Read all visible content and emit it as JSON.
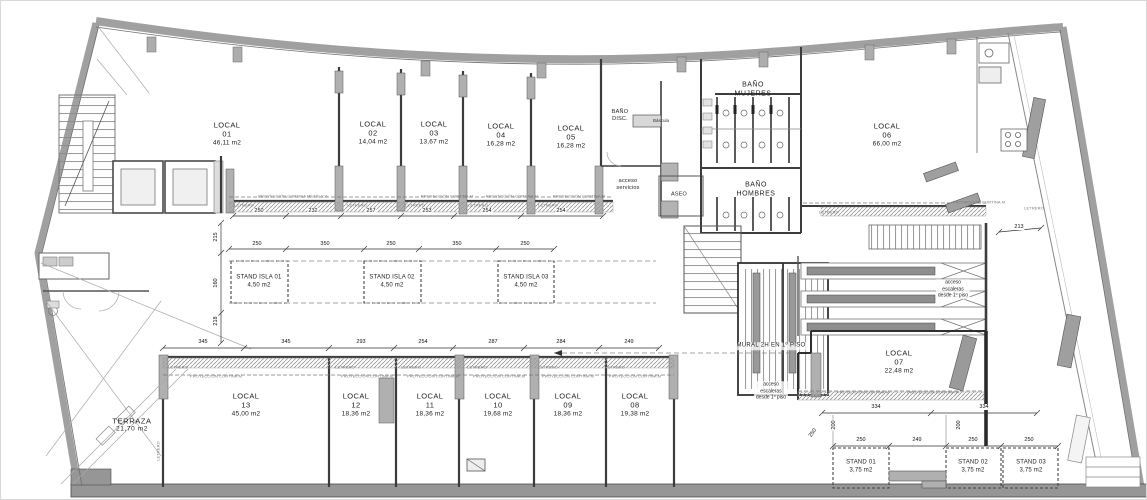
{
  "rooms": [
    {
      "name": "LOCAL",
      "num": "01",
      "area": "46,11 m2"
    },
    {
      "name": "LOCAL",
      "num": "02",
      "area": "14,04 m2"
    },
    {
      "name": "LOCAL",
      "num": "03",
      "area": "13,67 m2"
    },
    {
      "name": "LOCAL",
      "num": "04",
      "area": "16,28 m2"
    },
    {
      "name": "LOCAL",
      "num": "05",
      "area": "16,28 m2"
    },
    {
      "name": "LOCAL",
      "num": "06",
      "area": "66,00 m2"
    },
    {
      "name": "LOCAL",
      "num": "07",
      "area": "22,48 m2"
    },
    {
      "name": "LOCAL",
      "num": "08",
      "area": "19,38 m2"
    },
    {
      "name": "LOCAL",
      "num": "09",
      "area": "18,36 m2"
    },
    {
      "name": "LOCAL",
      "num": "10",
      "area": "19,68 m2"
    },
    {
      "name": "LOCAL",
      "num": "11",
      "area": "18,36 m2"
    },
    {
      "name": "LOCAL",
      "num": "12",
      "area": "18,36 m2"
    },
    {
      "name": "LOCAL",
      "num": "13",
      "area": "45,00 m2"
    }
  ],
  "island_stands": [
    {
      "name": "STAND ISLA 01",
      "area": "4,50 m2"
    },
    {
      "name": "STAND ISLA 02",
      "area": "4,50 m2"
    },
    {
      "name": "STAND ISLA 03",
      "area": "4,50 m2"
    }
  ],
  "stands": [
    {
      "name": "STAND 01",
      "area": "3,75 m2"
    },
    {
      "name": "STAND 02",
      "area": "3,75 m2"
    },
    {
      "name": "STAND 03",
      "area": "3,75 m2"
    }
  ],
  "areas": {
    "terraza": {
      "name": "TERRAZA",
      "area": "21,70 m2"
    },
    "bano_mujeres": {
      "l1": "BAÑO",
      "l2": "MUJERES"
    },
    "bano_hombres": {
      "l1": "BAÑO",
      "l2": "HOMBRES"
    },
    "bano_disc": {
      "l1": "BAÑO",
      "l2": "DISC."
    },
    "bascula": "Báscula",
    "aseo": "ASEO",
    "acceso_servicios": {
      "l1": "acceso",
      "l2": "servicios"
    },
    "mural": "MURAL 2H EN 1º PISO",
    "acceso_escaleras_mural": {
      "l1": "acceso",
      "l2": "escaleras",
      "l3": "desde 1º piso"
    },
    "acceso_escaleras_esc": {
      "l1": "acceso",
      "l2": "escaleras",
      "l3": "desde 1º piso"
    }
  },
  "colors": {
    "wall_gray": "#a0a0a0",
    "wall_dark": "#3c3c3c",
    "hatch": "#999999",
    "dash": "#777777"
  },
  "dims": [
    {
      "v": "250",
      "x": 258,
      "y": 210
    },
    {
      "v": "232",
      "x": 312,
      "y": 210
    },
    {
      "v": "257",
      "x": 370,
      "y": 210
    },
    {
      "v": "253",
      "x": 426,
      "y": 210
    },
    {
      "v": "254",
      "x": 486,
      "y": 210
    },
    {
      "v": "254",
      "x": 560,
      "y": 210
    },
    {
      "v": "250",
      "x": 256,
      "y": 243
    },
    {
      "v": "350",
      "x": 324,
      "y": 243
    },
    {
      "v": "250",
      "x": 390,
      "y": 243
    },
    {
      "v": "350",
      "x": 456,
      "y": 243
    },
    {
      "v": "250",
      "x": 524,
      "y": 243
    },
    {
      "v": "345",
      "x": 202,
      "y": 341
    },
    {
      "v": "345",
      "x": 285,
      "y": 341
    },
    {
      "v": "293",
      "x": 360,
      "y": 341
    },
    {
      "v": "254",
      "x": 422,
      "y": 341
    },
    {
      "v": "287",
      "x": 492,
      "y": 341
    },
    {
      "v": "284",
      "x": 560,
      "y": 341
    },
    {
      "v": "249",
      "x": 628,
      "y": 341
    },
    {
      "v": "250",
      "x": 860,
      "y": 439
    },
    {
      "v": "249",
      "x": 916,
      "y": 439
    },
    {
      "v": "250",
      "x": 972,
      "y": 439
    },
    {
      "v": "250",
      "x": 1028,
      "y": 439
    },
    {
      "v": "334",
      "x": 875,
      "y": 406
    },
    {
      "v": "334",
      "x": 983,
      "y": 406
    },
    {
      "v": "215",
      "x": 215,
      "y": 236,
      "r": -90
    },
    {
      "v": "160",
      "x": 215,
      "y": 282,
      "r": -90
    },
    {
      "v": "218",
      "x": 215,
      "y": 320,
      "r": -90
    },
    {
      "v": "213",
      "x": 1018,
      "y": 226
    },
    {
      "v": "250",
      "x": 812,
      "y": 432,
      "r": -55
    },
    {
      "v": "200",
      "x": 833,
      "y": 424,
      "r": -90
    },
    {
      "v": "200",
      "x": 958,
      "y": 424,
      "r": -90
    }
  ],
  "micro": [
    {
      "t": "PROYECCIÓN CORTINA METÁLICA",
      "x": 292,
      "y": 195
    },
    {
      "t": "PROYECCIÓN CORTINA M",
      "x": 446,
      "y": 195
    },
    {
      "t": "PROYECCIÓN CORTINA M",
      "x": 511,
      "y": 195
    },
    {
      "t": "PROYECCIÓN CORTINA M",
      "x": 578,
      "y": 195
    },
    {
      "t": "LETRERO",
      "x": 243,
      "y": 204
    },
    {
      "t": "LETRERO",
      "x": 356,
      "y": 204
    },
    {
      "t": "LETRERO",
      "x": 414,
      "y": 204
    },
    {
      "t": "LETRERO",
      "x": 477,
      "y": 204
    },
    {
      "t": "LETRERO",
      "x": 547,
      "y": 204
    },
    {
      "t": "LETRERO",
      "x": 828,
      "y": 211
    },
    {
      "t": "PROYECCIÓN CORTINA M",
      "x": 978,
      "y": 201
    },
    {
      "t": "LETRERO",
      "x": 1033,
      "y": 207
    },
    {
      "t": "LETRERO",
      "x": 177,
      "y": 366
    },
    {
      "t": "LETRERO",
      "x": 344,
      "y": 366
    },
    {
      "t": "LETRERO",
      "x": 410,
      "y": 366
    },
    {
      "t": "LETRERO",
      "x": 476,
      "y": 366
    },
    {
      "t": "LETRERO",
      "x": 547,
      "y": 366
    },
    {
      "t": "LETRERO",
      "x": 614,
      "y": 366
    },
    {
      "t": "PROYECCIÓN CORTINA M",
      "x": 215,
      "y": 375
    },
    {
      "t": "PROYECCIÓN CORTINA M",
      "x": 366,
      "y": 375
    },
    {
      "t": "PROYECCIÓN CORTINA M",
      "x": 432,
      "y": 375
    },
    {
      "t": "PROYECCIÓN CORTINA M",
      "x": 498,
      "y": 375
    },
    {
      "t": "PROYECCIÓN CORTINA M",
      "x": 567,
      "y": 375
    },
    {
      "t": "PROYECCIÓN CORTINA M",
      "x": 634,
      "y": 375
    },
    {
      "t": "LETRERO",
      "x": 812,
      "y": 394
    },
    {
      "t": "PROYECCIÓN CORTINA M",
      "x": 862,
      "y": 391
    },
    {
      "t": "PROYECCIÓN CORTINA M",
      "x": 932,
      "y": 391
    },
    {
      "t": "LETRERO",
      "x": 157,
      "y": 450,
      "r": -90
    }
  ]
}
